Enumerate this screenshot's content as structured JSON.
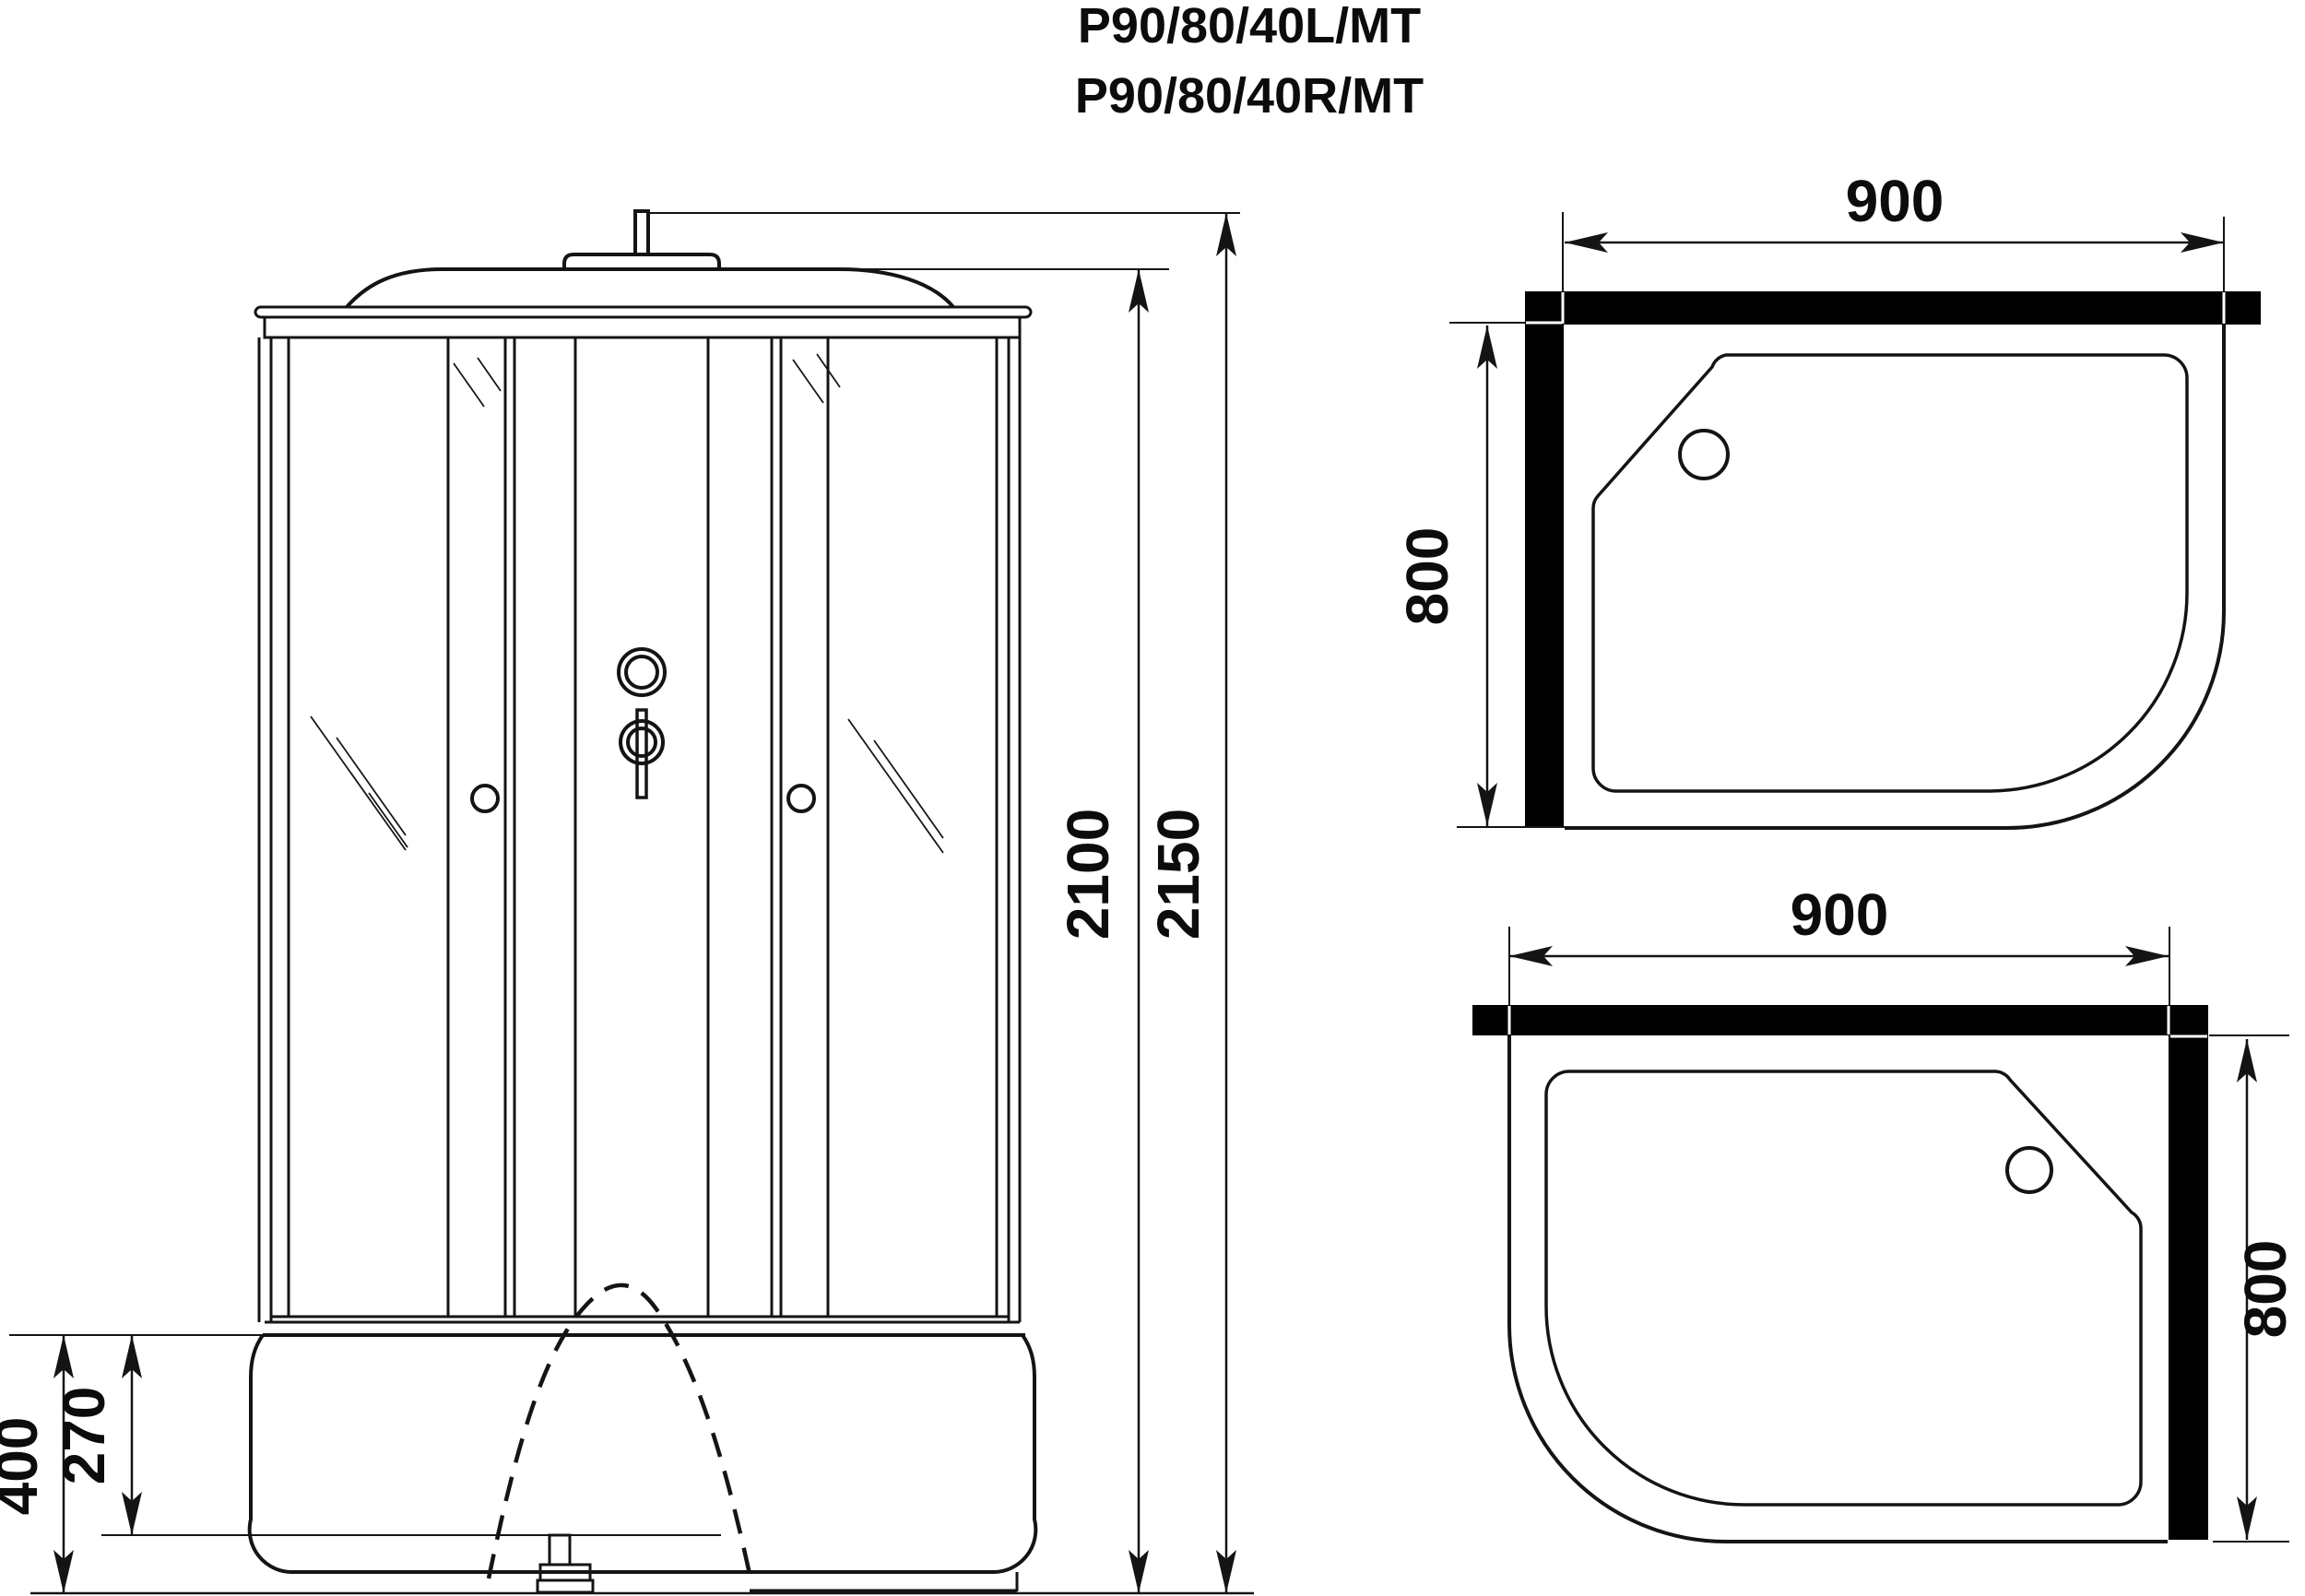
{
  "title": {
    "line1": "P90/80/40L/MT",
    "line2": "P90/80/40R/MT"
  },
  "front_view": {
    "dimensions": {
      "total_height_with_pipe": "2150",
      "cabin_height": "2100",
      "tray_height": "400",
      "tray_inner_height": "270"
    }
  },
  "plan_view_left": {
    "dimensions": {
      "width": "900",
      "depth": "800"
    }
  },
  "plan_view_right": {
    "dimensions": {
      "width": "900",
      "depth": "800"
    }
  },
  "colors": {
    "background": "#ffffff",
    "line": "#141414",
    "wall_fill": "#000000"
  }
}
